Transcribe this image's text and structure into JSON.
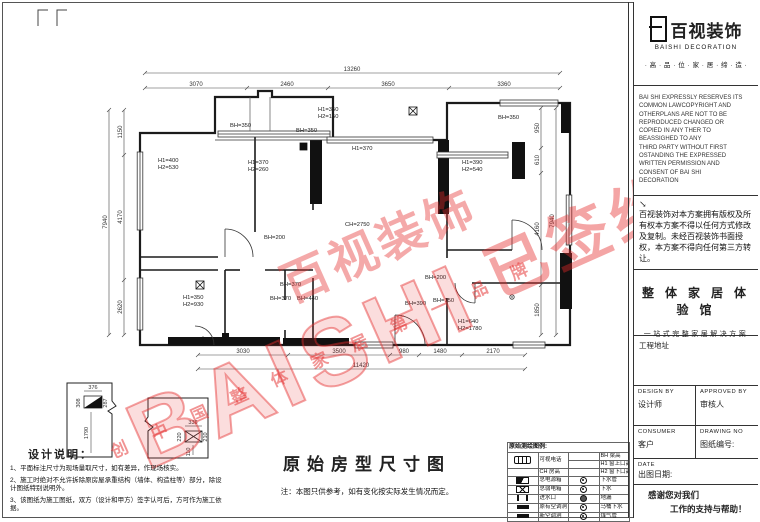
{
  "watermark": {
    "big": "BAISHI",
    "brand": "百视装饰",
    "signed": "已签约",
    "slogan": "创 中 国 整 体 家 居 第 一 品 牌"
  },
  "plan": {
    "dims": {
      "top": {
        "overall": "13260",
        "segs": [
          "3070",
          "2460",
          "3650",
          "3360"
        ]
      },
      "bottom": {
        "overall": "11420",
        "segs": [
          "3030",
          "3500",
          "980",
          "1480",
          "2170"
        ]
      },
      "left": {
        "overall": "7940",
        "segs": [
          "1150",
          "4170",
          "2620"
        ]
      },
      "right": {
        "overall": "7940",
        "segs": [
          "950",
          "610",
          "4160",
          "1850"
        ]
      }
    },
    "labels": {
      "left_bed": [
        "H1=400",
        "H2=530"
      ],
      "mid_left": [
        "H1=370",
        "H2=260"
      ],
      "balcony": [
        "H1=350",
        "H2=150"
      ],
      "bh350_a": "BH=350",
      "bh350_b": "BH=350",
      "bh350_c": "BH=350",
      "living_win": "H1=370",
      "right_bed": [
        "H1=390",
        "H2=540"
      ],
      "ceiling": "CH=2750",
      "bh200_a": "BH=200",
      "bh200_b": "BH=200",
      "kitchen": [
        "H1=350",
        "H2=930"
      ],
      "bh370_a": "BH=370",
      "bh370_b": "BH=370",
      "bh440": "BH=440",
      "bh390": "BH=390",
      "bh150": "BH=150",
      "entry": [
        "H1=640",
        "H2=1780"
      ]
    },
    "details": {
      "d1": {
        "top": "376",
        "left": "308",
        "right": "287",
        "vert": "1790"
      },
      "d2": {
        "top": "336",
        "left": "220",
        "right": "210",
        "bottom": "110"
      }
    }
  },
  "title_block": {
    "title": "原始房型尺寸图",
    "note": "注：本图只供参考，如有变化按实际发生情况而定。"
  },
  "design_notes": {
    "heading": "设计说明：",
    "items": [
      "1、平面标注尺寸为现场量取尺寸，如有差异，作现场核实。",
      "2、施工时绝对不允许拆除原房屋承重结构（墙体、构造柱等）部分，除设计图纸特别说明外。",
      "3、该图纸为施工图纸，双方（设计和甲方）签字认可后，方可作为施工依据。"
    ]
  },
  "legend": {
    "title": "原始测绘图例:",
    "rows": [
      {
        "l": "可视电话",
        "r": "BH 梁高"
      },
      {
        "l": "",
        "r": "H1 窗上口高"
      },
      {
        "l": "CH 房高",
        "r": "H2 窗下口高"
      },
      {
        "l": "总电源箱",
        "r": "下水管"
      },
      {
        "l": "总弱电箱",
        "r": "下水"
      },
      {
        "l": "进水口",
        "r": "地漏"
      },
      {
        "l": "原有空调洞",
        "r": "马桶下水"
      },
      {
        "l": "新空调洞",
        "r": "煤气管"
      }
    ]
  },
  "brand_panel": {
    "brand_cn": "百视装饰",
    "brand_en": "BAISHI DECORATION",
    "tagline": "· 高 · 品 · 位 · 家 · 居 · 缔 · 造 ·",
    "copyright_en": "BAI SHI EXPRESSLY RESERVES ITS\nCOMMON LAWCOPYRIGHT AND\nOTHERPLANS ARE NOT TO BE\nREPRODUCED CHANGED OR\nCOPIED IN ANY THER TO\nBEASSIGHED TO ANY\nTHIRD PARTY WITHOUT FIRST\nOSTANDING THE EXPRESSED\nWRITTEN PERMISSION AND\nCONSENT OF BAI SHI\nDECORATION",
    "arrow": "↘",
    "copyright_cn": "百视装饰对本方案拥有版权及所有权本方案不得以任何方式修改及复制。未经百视装饰书面授权，本方案不得向任何第三方转让。",
    "slogan_main": "整 体 家 居 体 验 馆",
    "slogan_sub": "一站式完整家居解决方案",
    "address_label": "工程地址",
    "table": {
      "design_by": "DESIGN BY",
      "designer": "设计师",
      "approved_by": "APPROVED BY",
      "approver": "审核人",
      "consumer": "CONSUMER",
      "client": "客户",
      "drawing_no": "DRAWING NO",
      "drawing_no_cn": "图纸编号:",
      "date": "DATE",
      "date_cn": "出图日期:",
      "thanks1": "感谢您对我们",
      "thanks2": "工作的支持与帮助！"
    }
  }
}
